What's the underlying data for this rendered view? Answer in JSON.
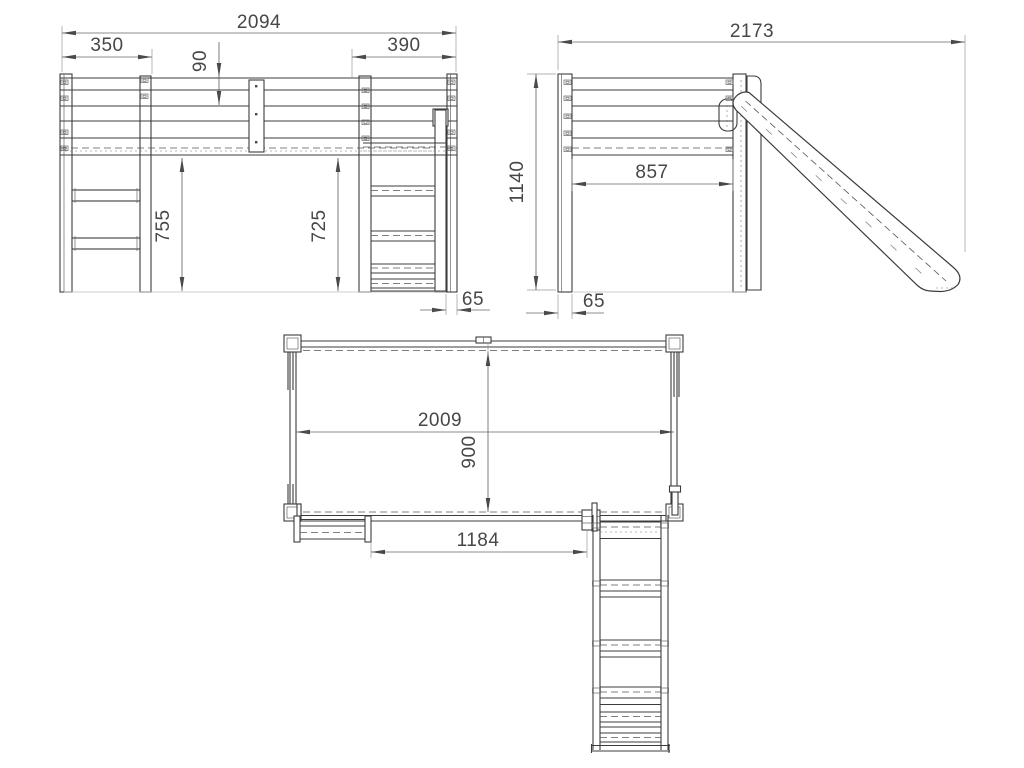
{
  "drawing": {
    "type": "technical-orthographic-drawing",
    "subject": "loft bed with slide and ladder",
    "colors": {
      "line": "#3c3c3c",
      "dimension": "#4a4a4a",
      "background": "#ffffff"
    }
  },
  "dims": {
    "front": {
      "overall_width": "2094",
      "left_section": "350",
      "right_section": "390",
      "rail_height": "90",
      "clearance_left": "755",
      "clearance_right": "725",
      "leg_thickness": "65"
    },
    "side": {
      "overall_depth": "2173",
      "overall_height": "1140",
      "inner_clearance": "857",
      "leg_thickness": "65"
    },
    "plan": {
      "bed_length": "2009",
      "bed_width": "900",
      "ladder_gap": "1184"
    }
  }
}
